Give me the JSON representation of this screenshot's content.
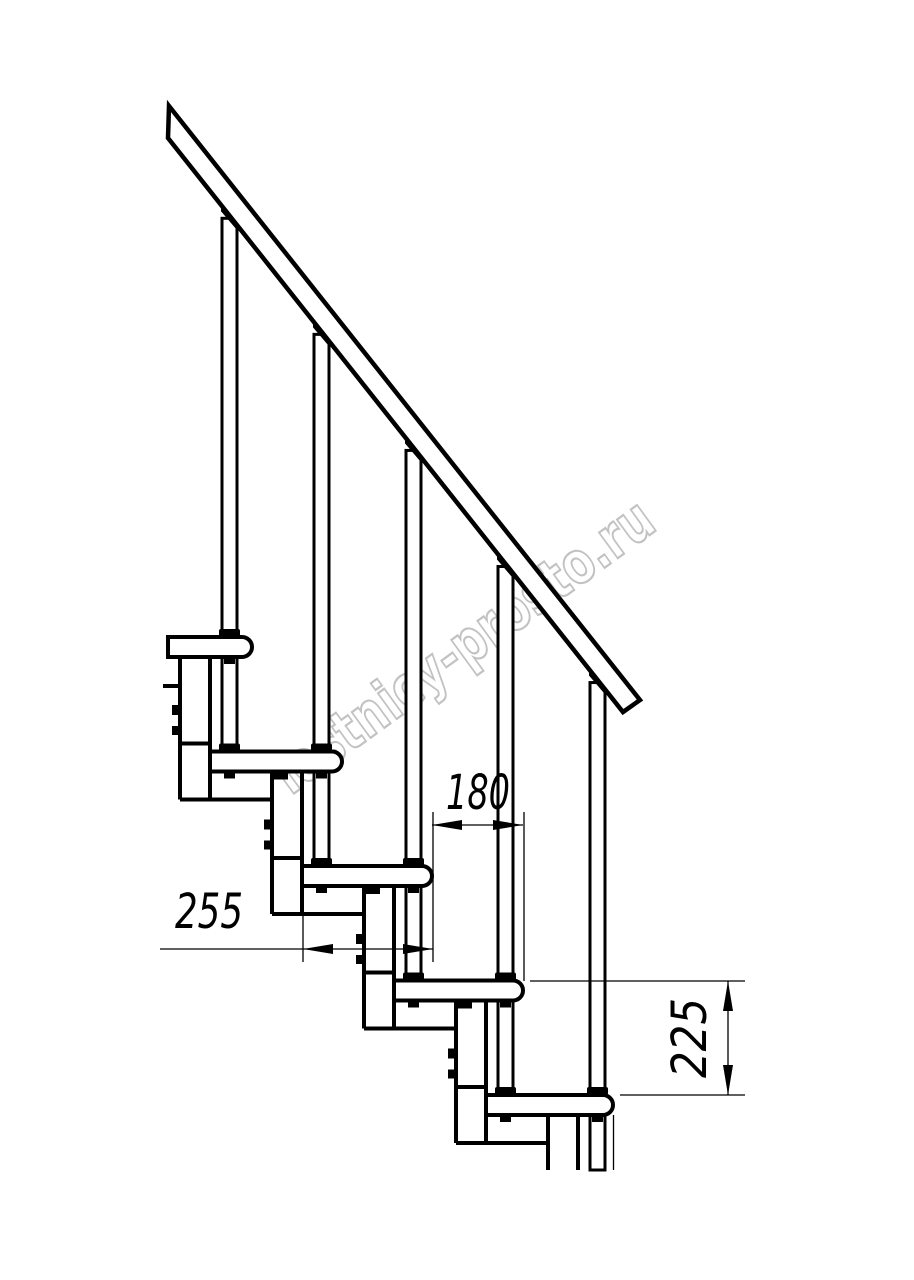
{
  "drawing": {
    "type": "technical-diagram",
    "subject": "modular staircase side elevation with handrail",
    "units": "mm",
    "canvas": {
      "w": 914,
      "h": 1280,
      "bg": "#ffffff"
    },
    "ink": "#000000",
    "thin": 1.3,
    "thick": 4,
    "cut_y": 1170,
    "rail": {
      "upper": [
        169,
        106,
        640,
        700
      ],
      "lower": [
        168,
        138,
        623,
        712
      ],
      "stroke": 4.5
    },
    "tread_thickness": 20,
    "tread_end_radius": 10,
    "treads": [
      {
        "left": 168,
        "right": 252,
        "top": 637
      },
      {
        "left": 210,
        "right": 342,
        "top": 751.5
      },
      {
        "left": 302,
        "right": 432,
        "top": 866
      },
      {
        "left": 394,
        "right": 523,
        "top": 980.5
      },
      {
        "left": 486,
        "right": 613,
        "top": 1095
      }
    ],
    "balusters": {
      "xs": [
        222,
        314,
        406,
        498,
        590
      ],
      "width": 15
    },
    "boxes": {
      "lefts": [
        180,
        272,
        364,
        456,
        548
      ],
      "width": 30,
      "bolt_offsets": [
        68,
        89
      ]
    },
    "stub": {
      "y": 686,
      "x1": 163,
      "x2": 180
    },
    "tail_line": {
      "x": 613.5,
      "y1": 1115,
      "y2": 1170
    },
    "watermark": {
      "text": "lestnicy-prosto.ru",
      "color": "#c2c2c2",
      "cx": 463,
      "cy": 646,
      "angle": -36,
      "font_size": 58,
      "length": 455
    },
    "dim_font_size": 48,
    "dimensions": [
      {
        "label": "180",
        "type": "h",
        "y": 825,
        "x1": 432,
        "x2": 523,
        "exts": [
          [
            433,
            812,
            433,
            962
          ],
          [
            524,
            812,
            524,
            981
          ]
        ],
        "tx": 478,
        "ty": 809,
        "text_length": 64
      },
      {
        "label": "255",
        "type": "h",
        "y": 949,
        "x1": 303,
        "x2": 433,
        "tail_x": 160,
        "exts": [
          [
            303,
            916,
            303,
            962
          ]
        ],
        "tx": 209,
        "ty": 928,
        "text_length": 68
      },
      {
        "label": "225",
        "type": "v",
        "x": 728,
        "y1": 981,
        "y2": 1095,
        "exts": [
          [
            530,
            981,
            745,
            981
          ],
          [
            620,
            1095,
            745,
            1095
          ]
        ],
        "tx": 706,
        "ty": 1038,
        "text_length": 80
      }
    ]
  }
}
